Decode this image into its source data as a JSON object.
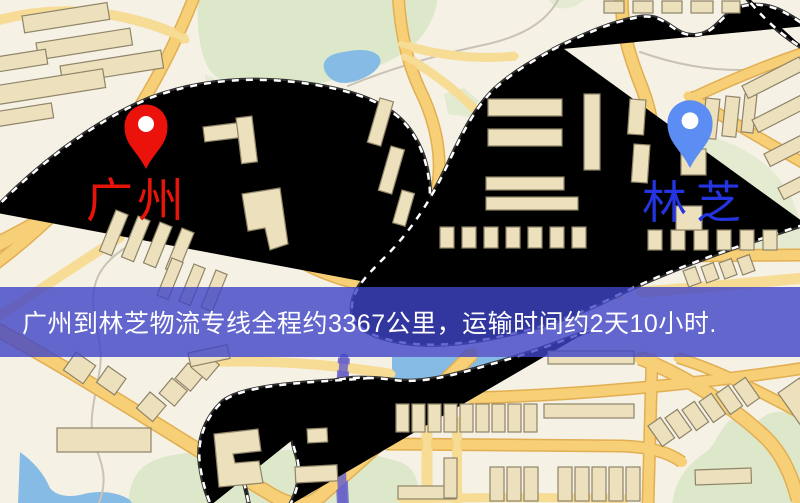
{
  "map": {
    "origin": {
      "label": "广州",
      "pin_color": "#ea120a",
      "label_color": "#e81409"
    },
    "destination": {
      "label": "林芝",
      "pin_color": "#5c8df2",
      "label_color": "#2334e0"
    }
  },
  "banner": {
    "text": "广州到林芝物流专线全程约3367公里，运输时间约2天10小时.",
    "background_color": "rgba(63,67,199,0.80)",
    "text_color": "#ffffff"
  },
  "palette": {
    "map_background": "#f6f1e5",
    "road_fill": "#f6cf76",
    "road_casing": "#e2ae52",
    "park": "#dde8ca",
    "water": "#85bbe4",
    "building_fill": "#ece0bd",
    "building_stroke": "#8f8468",
    "railway": "#2e2e2e"
  }
}
